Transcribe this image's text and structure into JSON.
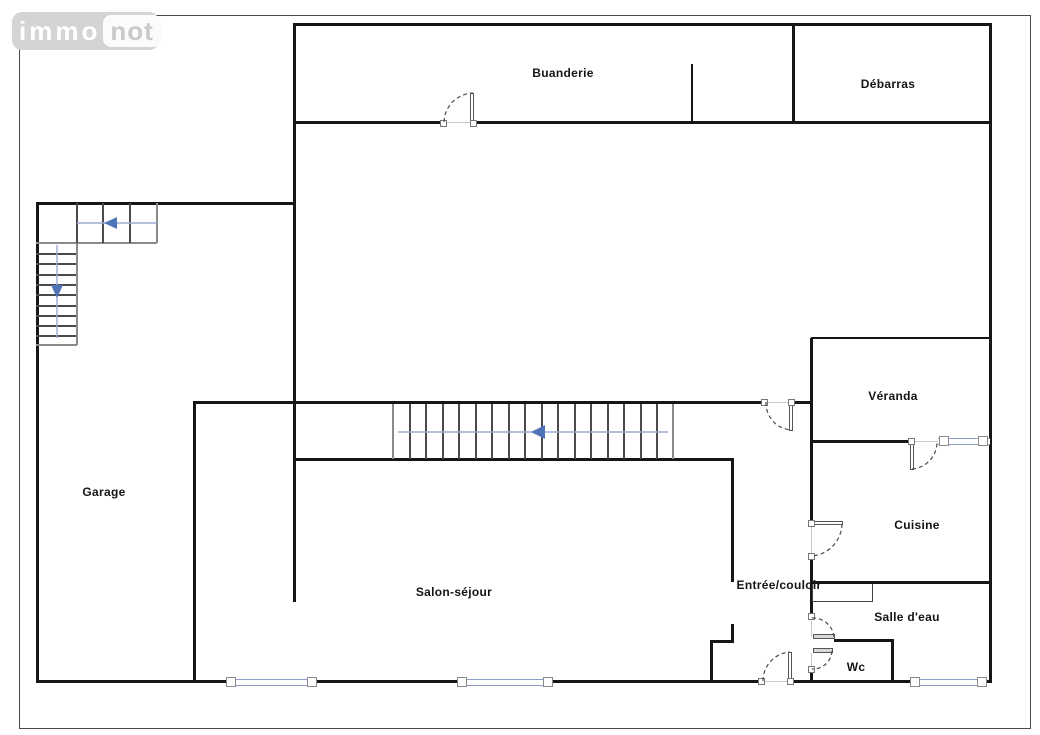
{
  "logo": {
    "immo": "immo",
    "not": "not"
  },
  "rooms": {
    "buanderie": "Buanderie",
    "debarras": "Débarras",
    "garage": "Garage",
    "veranda": "Véranda",
    "cuisine": "Cuisine",
    "entree": "Entrée/couloir",
    "salon": "Salon-séjour",
    "salle_eau": "Salle d'eau",
    "wc": "Wc"
  },
  "colors": {
    "wall": "#161616",
    "window_blue": "#8e9ec6",
    "arrow_blue": "#4f74b8",
    "arrow_line_blue": "#9aaad2",
    "logo_bg": "#d4d4d4",
    "logo_immo_text": "#ffffff",
    "logo_not_bg": "#fbfbfb",
    "logo_not_text": "#c9c9c9"
  }
}
